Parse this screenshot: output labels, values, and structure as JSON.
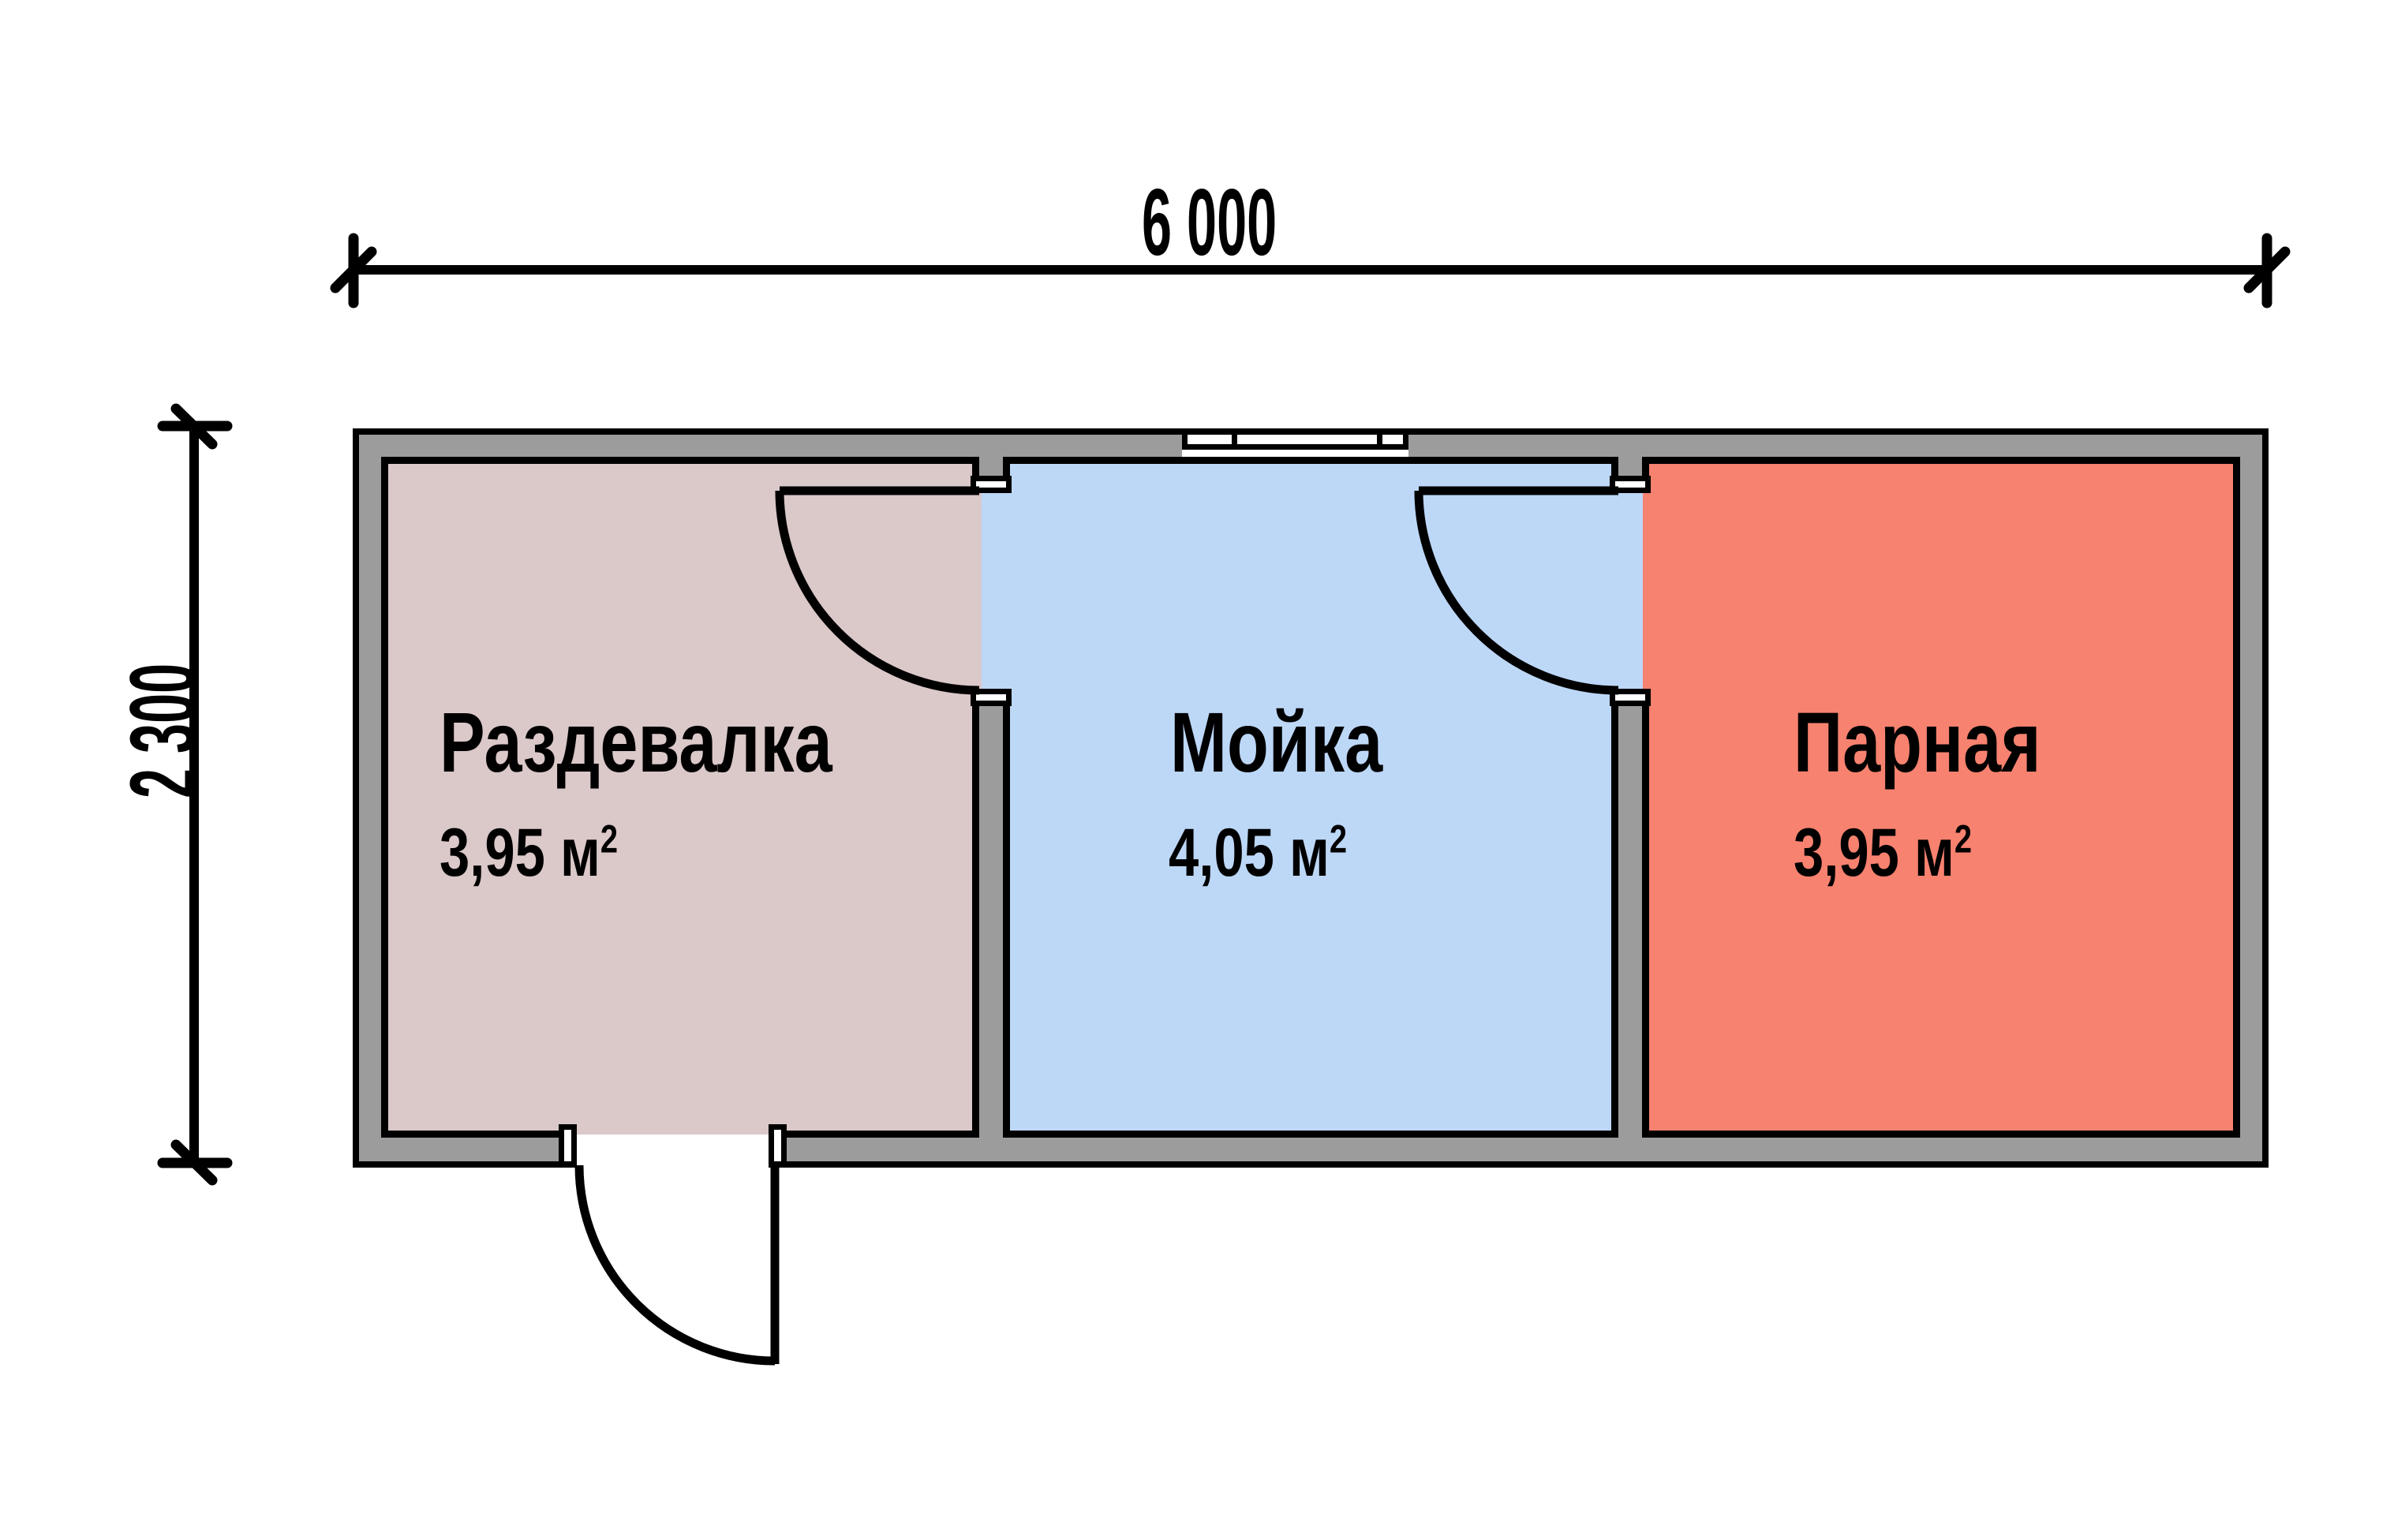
{
  "plan": {
    "dimension_width": "6 000",
    "dimension_height": "2 300"
  },
  "rooms": [
    {
      "name": "Раздевалка",
      "area": "3,95 м",
      "area_sup": "2",
      "color": "#dbc8c8"
    },
    {
      "name": "Мойка",
      "area": "4,05 м",
      "area_sup": "2",
      "color": "#bdd7f7"
    },
    {
      "name": "Парная",
      "area": "3,95 м",
      "area_sup": "2",
      "color": "#f7826f"
    }
  ],
  "colors": {
    "wall": "#9c9c9c",
    "outline": "#000000",
    "door_fill": "#ffffff",
    "background": "#ffffff"
  }
}
